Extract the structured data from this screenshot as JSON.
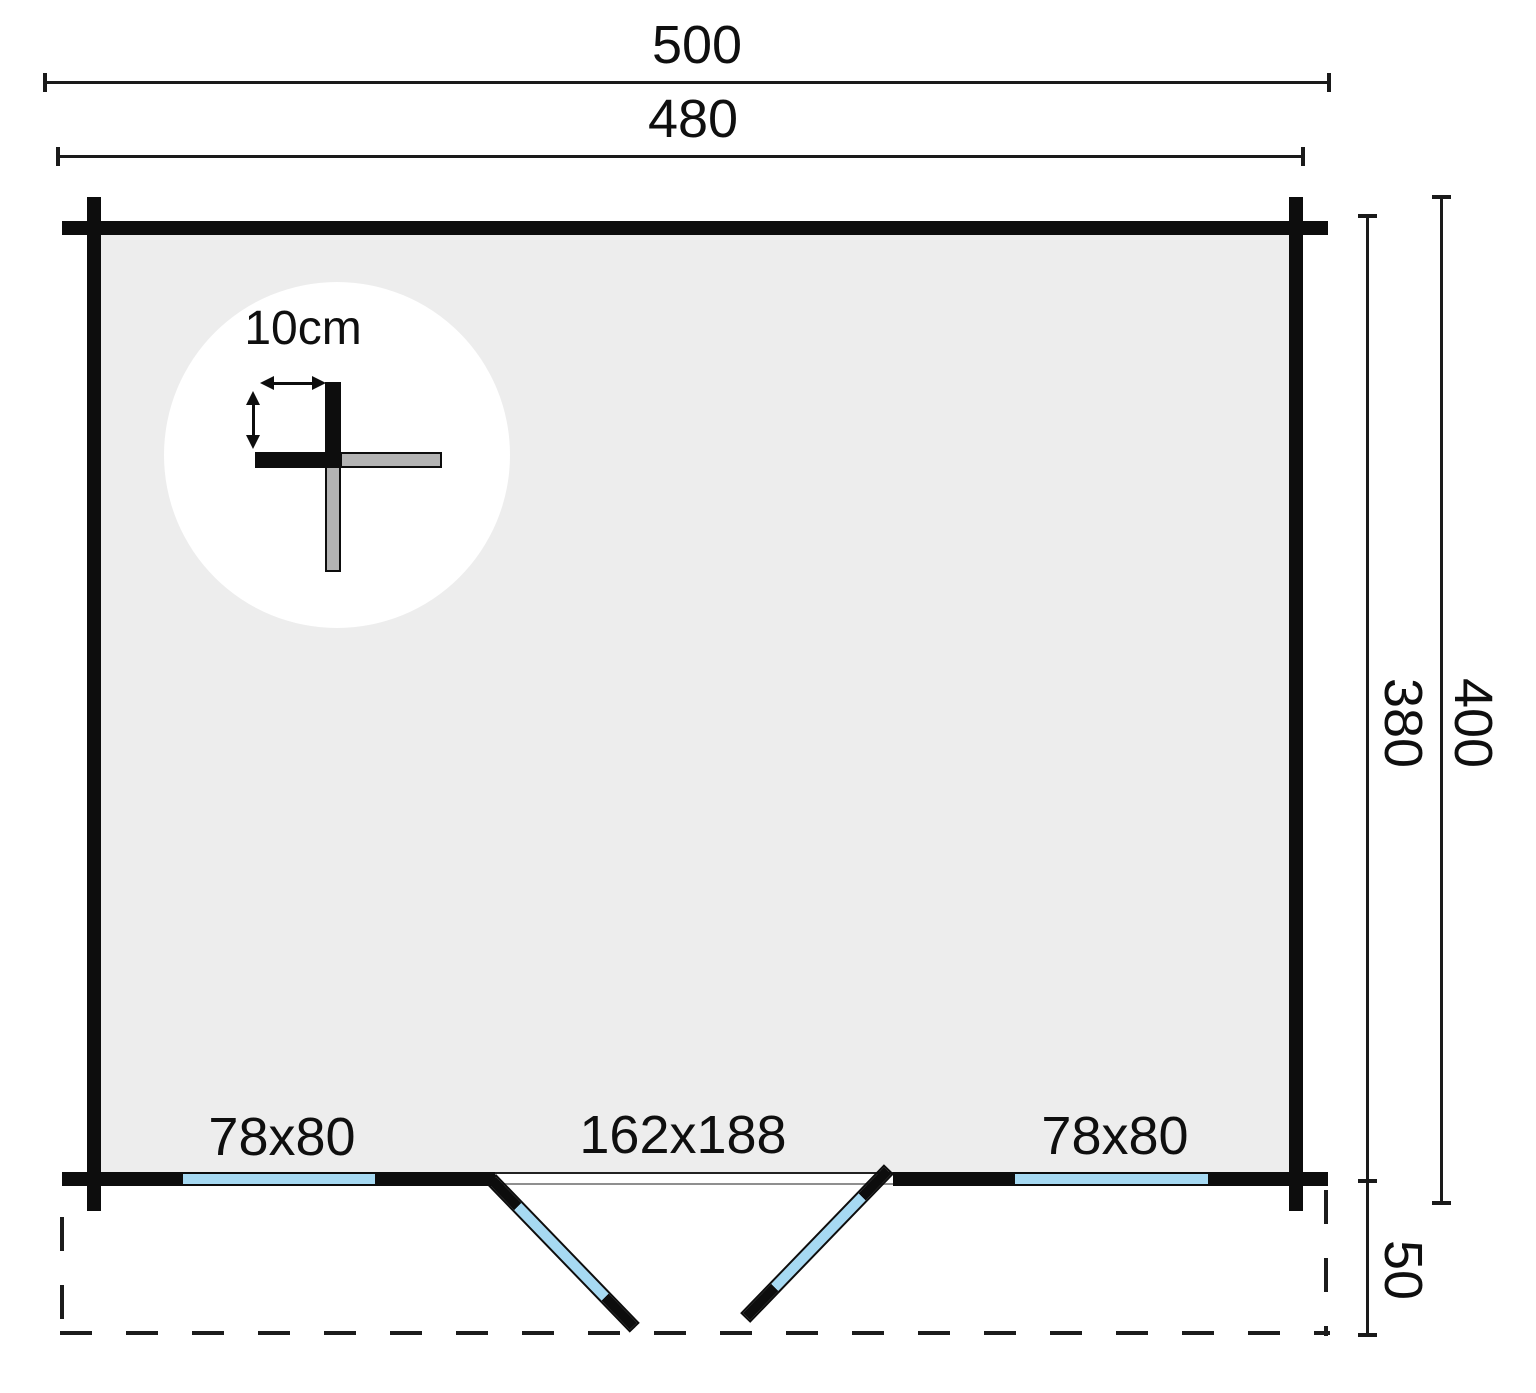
{
  "plan": {
    "outer_width": "500",
    "inner_width": "480",
    "outer_depth": "400",
    "inner_depth": "380",
    "overhang_depth": "50",
    "wall_thickness_label": "10cm",
    "left_window_label": "78x80",
    "door_label": "162x188",
    "right_window_label": "78x80"
  },
  "colors": {
    "wall": "#0d0d0d",
    "floor": "#ededed",
    "window_glass": "#a6d9f2",
    "log_gray": "#b3b3b3",
    "background": "#ffffff"
  }
}
